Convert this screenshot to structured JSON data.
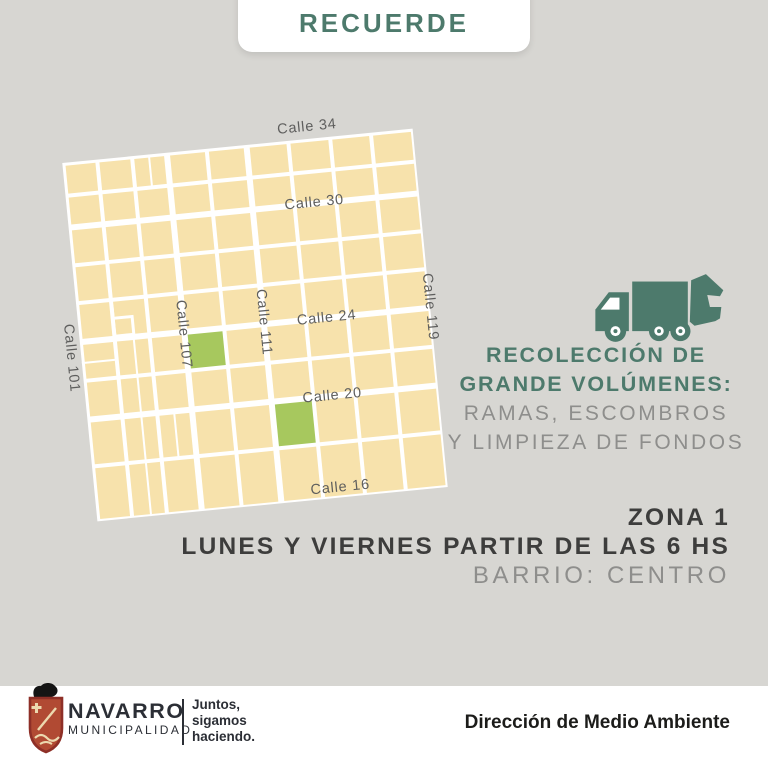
{
  "colors": {
    "background": "#d7d6d2",
    "card": "#ffffff",
    "accent_teal": "#4d7a6c",
    "map_block_beige": "#f7e2ac",
    "map_highlight_green": "#a7c85e",
    "street_white": "#ffffff",
    "map_label_gray": "#5e5e5d",
    "text_dark": "#3d3d3c",
    "text_gray": "#8e8e8c",
    "logo_dark": "#2b2e35",
    "logo_red": "#a63a30"
  },
  "header": {
    "title": "RECUERDE"
  },
  "map": {
    "horizontal_streets": [
      "Calle 34",
      "Calle 30",
      "Calle 24",
      "Calle 20",
      "Calle 16"
    ],
    "vertical_streets": [
      "Calle 101",
      "Calle 107",
      "Calle 111",
      "Calle 119"
    ],
    "highlighted_blocks": [
      {
        "col": 3,
        "row": 5
      },
      {
        "col": 5,
        "row": 7
      }
    ]
  },
  "info": {
    "truck_icon": "garbage-truck-icon",
    "heading_line1": "RECOLECCIÓN DE",
    "heading_line2": "GRANDE VOLÚMENES:",
    "sub_line1": "RAMAS, ESCOMBROS",
    "sub_line2": "Y LIMPIEZA DE FONDOS"
  },
  "schedule": {
    "zone": "ZONA 1",
    "days": "LUNES Y VIERNES PARTIR DE LAS 6 HS",
    "barrio": "BARRIO: CENTRO"
  },
  "footer": {
    "org_name": "NAVARRO",
    "org_subtitle": "MUNICIPALIDAD",
    "slogan_line1": "Juntos,",
    "slogan_line2": "sigamos",
    "slogan_line3": "haciendo.",
    "department": "Dirección de Medio Ambiente"
  }
}
